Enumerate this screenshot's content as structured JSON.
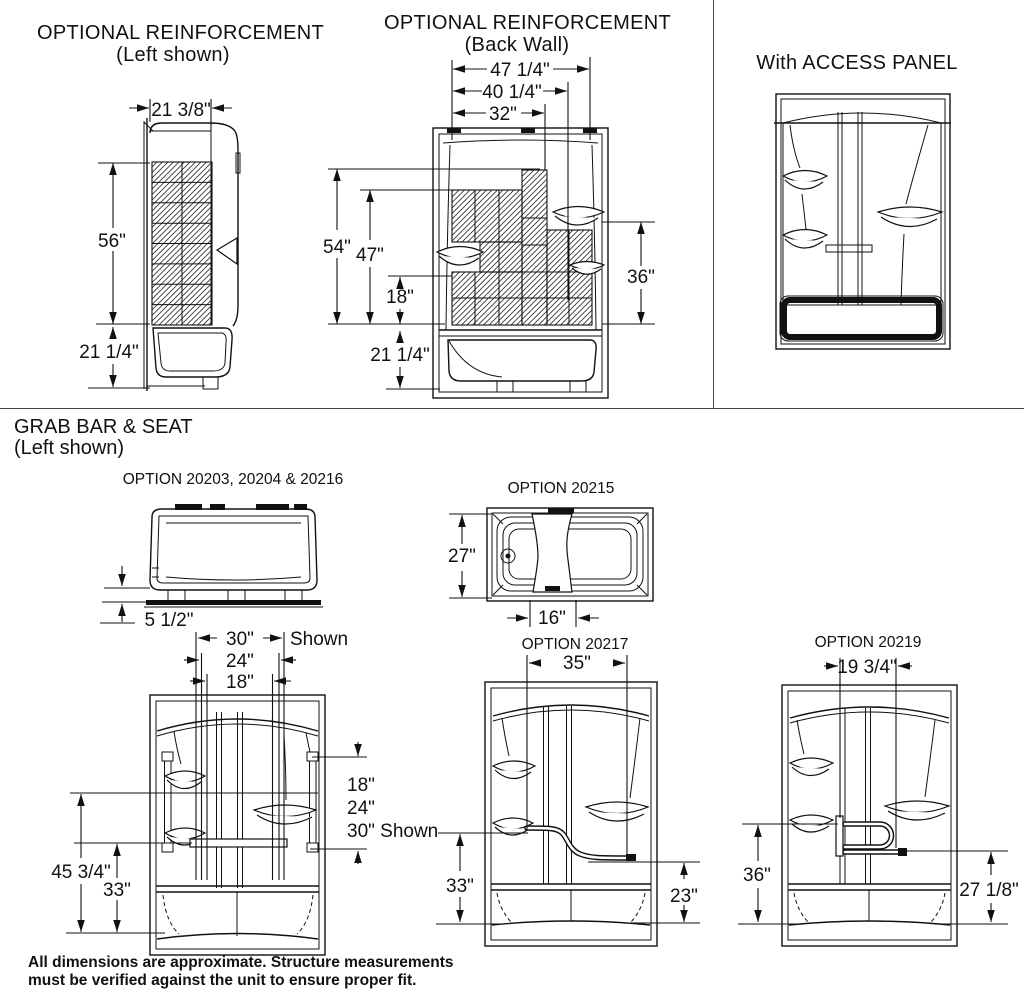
{
  "sections": {
    "reinforcement_left": {
      "title": "OPTIONAL REINFORCEMENT",
      "subtitle": "(Left shown)",
      "dims": {
        "width": "21 3/8\"",
        "wall_height": "56\"",
        "tub_height": "21 1/4\""
      }
    },
    "reinforcement_back": {
      "title": "OPTIONAL REINFORCEMENT",
      "subtitle": "(Back Wall)",
      "dims": {
        "width_outer": "47 1/4\"",
        "width_mid": "40 1/4\"",
        "width_inner": "32\"",
        "height_full": "54\"",
        "height_wall": "47\"",
        "height_lower": "18\"",
        "height_tub": "21 1/4\"",
        "height_right": "36\""
      }
    },
    "access_panel": {
      "title": "With ACCESS PANEL"
    },
    "grab_bar_seat": {
      "title": "GRAB BAR & SEAT",
      "subtitle": "(Left shown)",
      "option_a": {
        "label": "OPTION 20203, 20204 & 20216",
        "dims": {
          "apron_height": "5 1/2\""
        }
      },
      "option_20215": {
        "label": "OPTION 20215",
        "dims": {
          "depth": "27\"",
          "seat_width": "16\""
        }
      },
      "elevation": {
        "dims": {
          "top_30": "30\"",
          "shown_label": "Shown",
          "top_24": "24\"",
          "top_18": "18\"",
          "side_18": "18\"",
          "side_24": "24\"",
          "side_30_shown": "30\" Shown",
          "height_main": "45 3/4\"",
          "height_inner": "33\""
        }
      },
      "option_20217": {
        "label": "OPTION 20217",
        "dims": {
          "width": "35\"",
          "left_height": "33\"",
          "right_height": "23\""
        }
      },
      "option_20219": {
        "label": "OPTION 20219",
        "dims": {
          "width": "19 3/4\"",
          "left_height": "36\"",
          "right_height": "27 1/8\""
        }
      }
    }
  },
  "footnote": {
    "line1": "All dimensions are approximate. Structure measurements",
    "line2": "must be verified against the unit to ensure proper fit."
  }
}
